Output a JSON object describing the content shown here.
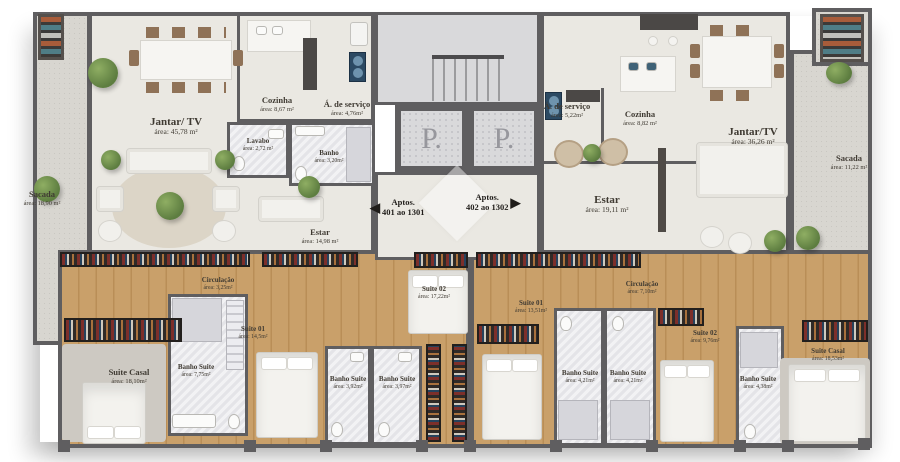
{
  "core": {
    "elevator_label": "P.",
    "sign_left": {
      "line1": "Aptos.",
      "line2": "401 ao 1301",
      "arrow": "◀"
    },
    "sign_right": {
      "line1": "Aptos.",
      "line2": "402 ao 1302",
      "arrow": "▶"
    }
  },
  "unit_left": {
    "sacada": {
      "name": "Sacada",
      "area": "área: 18,90 m²"
    },
    "jantar_tv": {
      "name": "Jantar/ TV",
      "area": "área: 45,78 m²"
    },
    "cozinha": {
      "name": "Cozinha",
      "area": "área: 8,67 m²"
    },
    "servico": {
      "name": "Á. de serviço",
      "area": "área: 4,76m²"
    },
    "lavabo": {
      "name": "Lavabo",
      "area": "área: 2,72 m²"
    },
    "banho": {
      "name": "Banho",
      "area": "área: 3,20m²"
    },
    "estar": {
      "name": "Estar",
      "area": "área: 14,98 m²"
    },
    "circulacao": {
      "name": "Circulação",
      "area": "área: 3,25m²"
    },
    "suite_casal": {
      "name": "Suite Casal",
      "area": "área: 18,10m²"
    },
    "banho_casal": {
      "name": "Banho Suite",
      "area": "área: 7,75m²"
    },
    "suite_01": {
      "name": "Suite 01",
      "area": "área: 14,5m²"
    },
    "banho_s01": {
      "name": "Banho Suite",
      "area": "área: 3,92m²"
    },
    "suite_02": {
      "name": "Suite 02",
      "area": "área: 17,22m²"
    },
    "banho_s02": {
      "name": "Banho Suite",
      "area": "área: 3,97m²"
    }
  },
  "unit_right": {
    "servico": {
      "name": "Á. de serviço",
      "area": "área: 5,22m²"
    },
    "cozinha": {
      "name": "Cozinha",
      "area": "área: 8,82 m²"
    },
    "estar": {
      "name": "Estar",
      "area": "área: 19,11 m²"
    },
    "jantar_tv": {
      "name": "Jantar/TV",
      "area": "área: 36,26 m²"
    },
    "sacada": {
      "name": "Sacada",
      "area": "área: 11,22 m²"
    },
    "suite_01": {
      "name": "Suite 01",
      "area": "área: 13,51m²"
    },
    "circulacao": {
      "name": "Circulação",
      "area": "área: 7,10m²"
    },
    "banho_a": {
      "name": "Banho Suite",
      "area": "área: 4,21m²"
    },
    "banho_b": {
      "name": "Banho Suite",
      "area": "área: 4,21m²"
    },
    "suite_02": {
      "name": "Suite 02",
      "area": "área: 9,76m²"
    },
    "banho_s02": {
      "name": "Banho Suite",
      "area": "área: 4,38m²"
    },
    "suite_casal": {
      "name": "Suite Casal",
      "area": "área: 18,53m²"
    }
  },
  "colors": {
    "wall": "#5f5e60",
    "living_floor": "#eae8e2",
    "wood_floor": "#c9a06a",
    "bath_floor": "#e4e4e8",
    "balcony_floor": "#d8d6d0",
    "plant_green": "#6f8f52",
    "label_ink": "#3f3a32"
  }
}
